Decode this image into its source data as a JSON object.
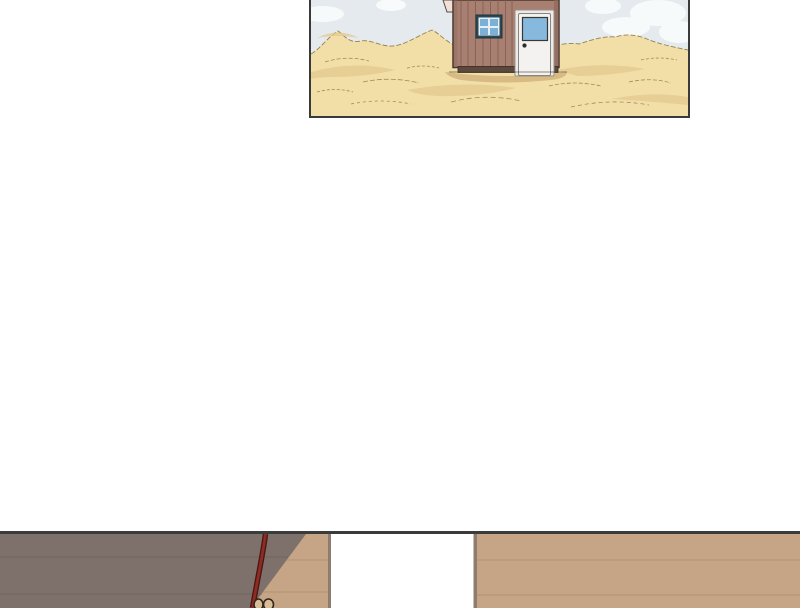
{
  "page": {
    "kind": "webtoon comic strip page",
    "background_color": "#ffffff"
  },
  "panels": {
    "desert": {
      "alt": "Lone wooden cabin with a white door standing among pale desert sand dunes under a light sky with clouds; panel cropped by top of screen",
      "border_color": "#3a3a3a",
      "sky_color": "#e4eaed",
      "cloud_color": "#fafcfc",
      "sand_color": "#f1dfa7",
      "sand_shadow_color": "#e3c990",
      "sand_outline_color": "#8d7646",
      "cabin": {
        "wall_color": "#a87f71",
        "plank_line_color": "#7d5e51",
        "outline_color": "#4a382f",
        "edge_shade_color": "#8d6a5d",
        "blade_color": "#f0e0d8",
        "window_frame_color": "#2b4a59",
        "window_mullion_color": "#e8eef0",
        "window_pane_color": "#79b1d9",
        "door_trim_color": "#ecebe8",
        "door_color": "#f4f2f0",
        "door_glass_color": "#86b9dd",
        "door_knob_color": "#2e2b28",
        "foundation_color": "#5d483d",
        "ground_shadow_color": "#d8ba83"
      }
    },
    "interior": {
      "alt": "Top sliver of an interior scene: dark taupe shadowed wall on the left, bright white open doorway in the middle, tan wood plank wall on the right, and a red rope hanging down ending in a looped knot; panel cropped by bottom of screen",
      "border_color": "#3b3b3b",
      "shadow_wall_color": "#7e706a",
      "shadow_seam_color": "#6d6059",
      "plank_wall_color": "#c5a585",
      "plank_seam_color": "#a88c6c",
      "doorway_color": "#ffffff",
      "door_jamb_color": "#8d7d6f",
      "rope_edge_color": "#4c1713",
      "rope_color": "#8c2c24",
      "knot_fill_color": "#d9bd96",
      "knot_outline_color": "#33241c"
    }
  }
}
